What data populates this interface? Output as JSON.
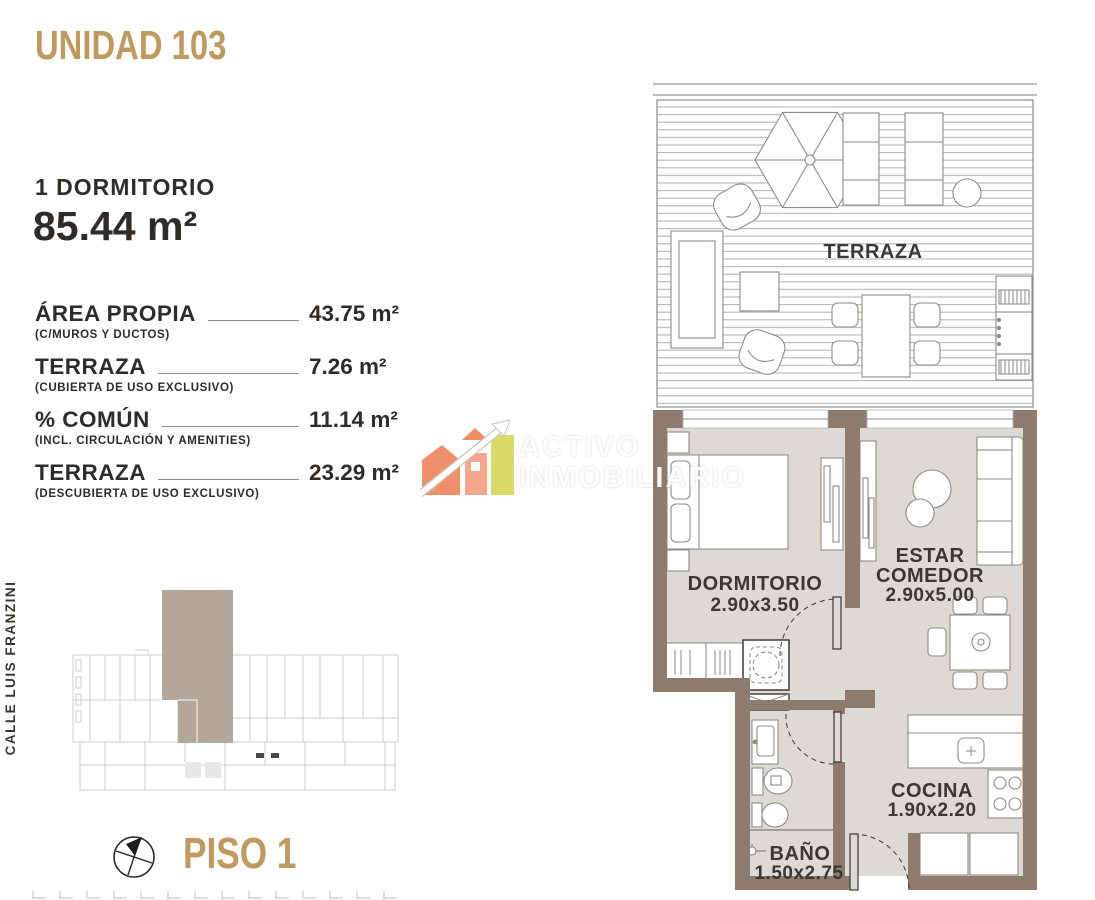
{
  "header": {
    "unit_title": "UNIDAD 103",
    "bedrooms": "1 DORMITORIO",
    "total_area": "85.44 m²"
  },
  "areas": [
    {
      "label": "ÁREA PROPIA",
      "sublabel": "(C/MUROS Y DUCTOS)",
      "value": "43.75 m²"
    },
    {
      "label": "TERRAZA",
      "sublabel": "(CUBIERTA DE USO EXCLUSIVO)",
      "value": "7.26 m²"
    },
    {
      "label": "% COMÚN",
      "sublabel": "(INCL. CIRCULACIÓN Y AMENITIES)",
      "value": "11.14 m²"
    },
    {
      "label": "TERRAZA",
      "sublabel": "(DESCUBIERTA DE USO EXCLUSIVO)",
      "value": "23.29 m²"
    }
  ],
  "location": {
    "street": "CALLE LUIS FRANZINI",
    "floor_label": "PISO 1"
  },
  "watermark": {
    "line1": "ACTIVO",
    "line2": "INMOBILIARIO"
  },
  "floorplan": {
    "terraza": {
      "name": "TERRAZA"
    },
    "dormitorio": {
      "name": "DORMITORIO",
      "dims": "2.90x3.50"
    },
    "estar": {
      "line1": "ESTAR",
      "line2": "COMEDOR",
      "dims": "2.90x5.00"
    },
    "cocina": {
      "name": "COCINA",
      "dims": "1.90x2.20"
    },
    "bano": {
      "name": "BAÑO",
      "dims": "1.50x2.75"
    }
  },
  "colors": {
    "gold": "#c0995f",
    "wall": "#8d7b6e",
    "floor": "#ddd9d4",
    "unit_highlight": "#b3a79a",
    "logo_orange": "#f0906a",
    "logo_salmon": "#f5a68c",
    "logo_green": "#d8d966"
  }
}
